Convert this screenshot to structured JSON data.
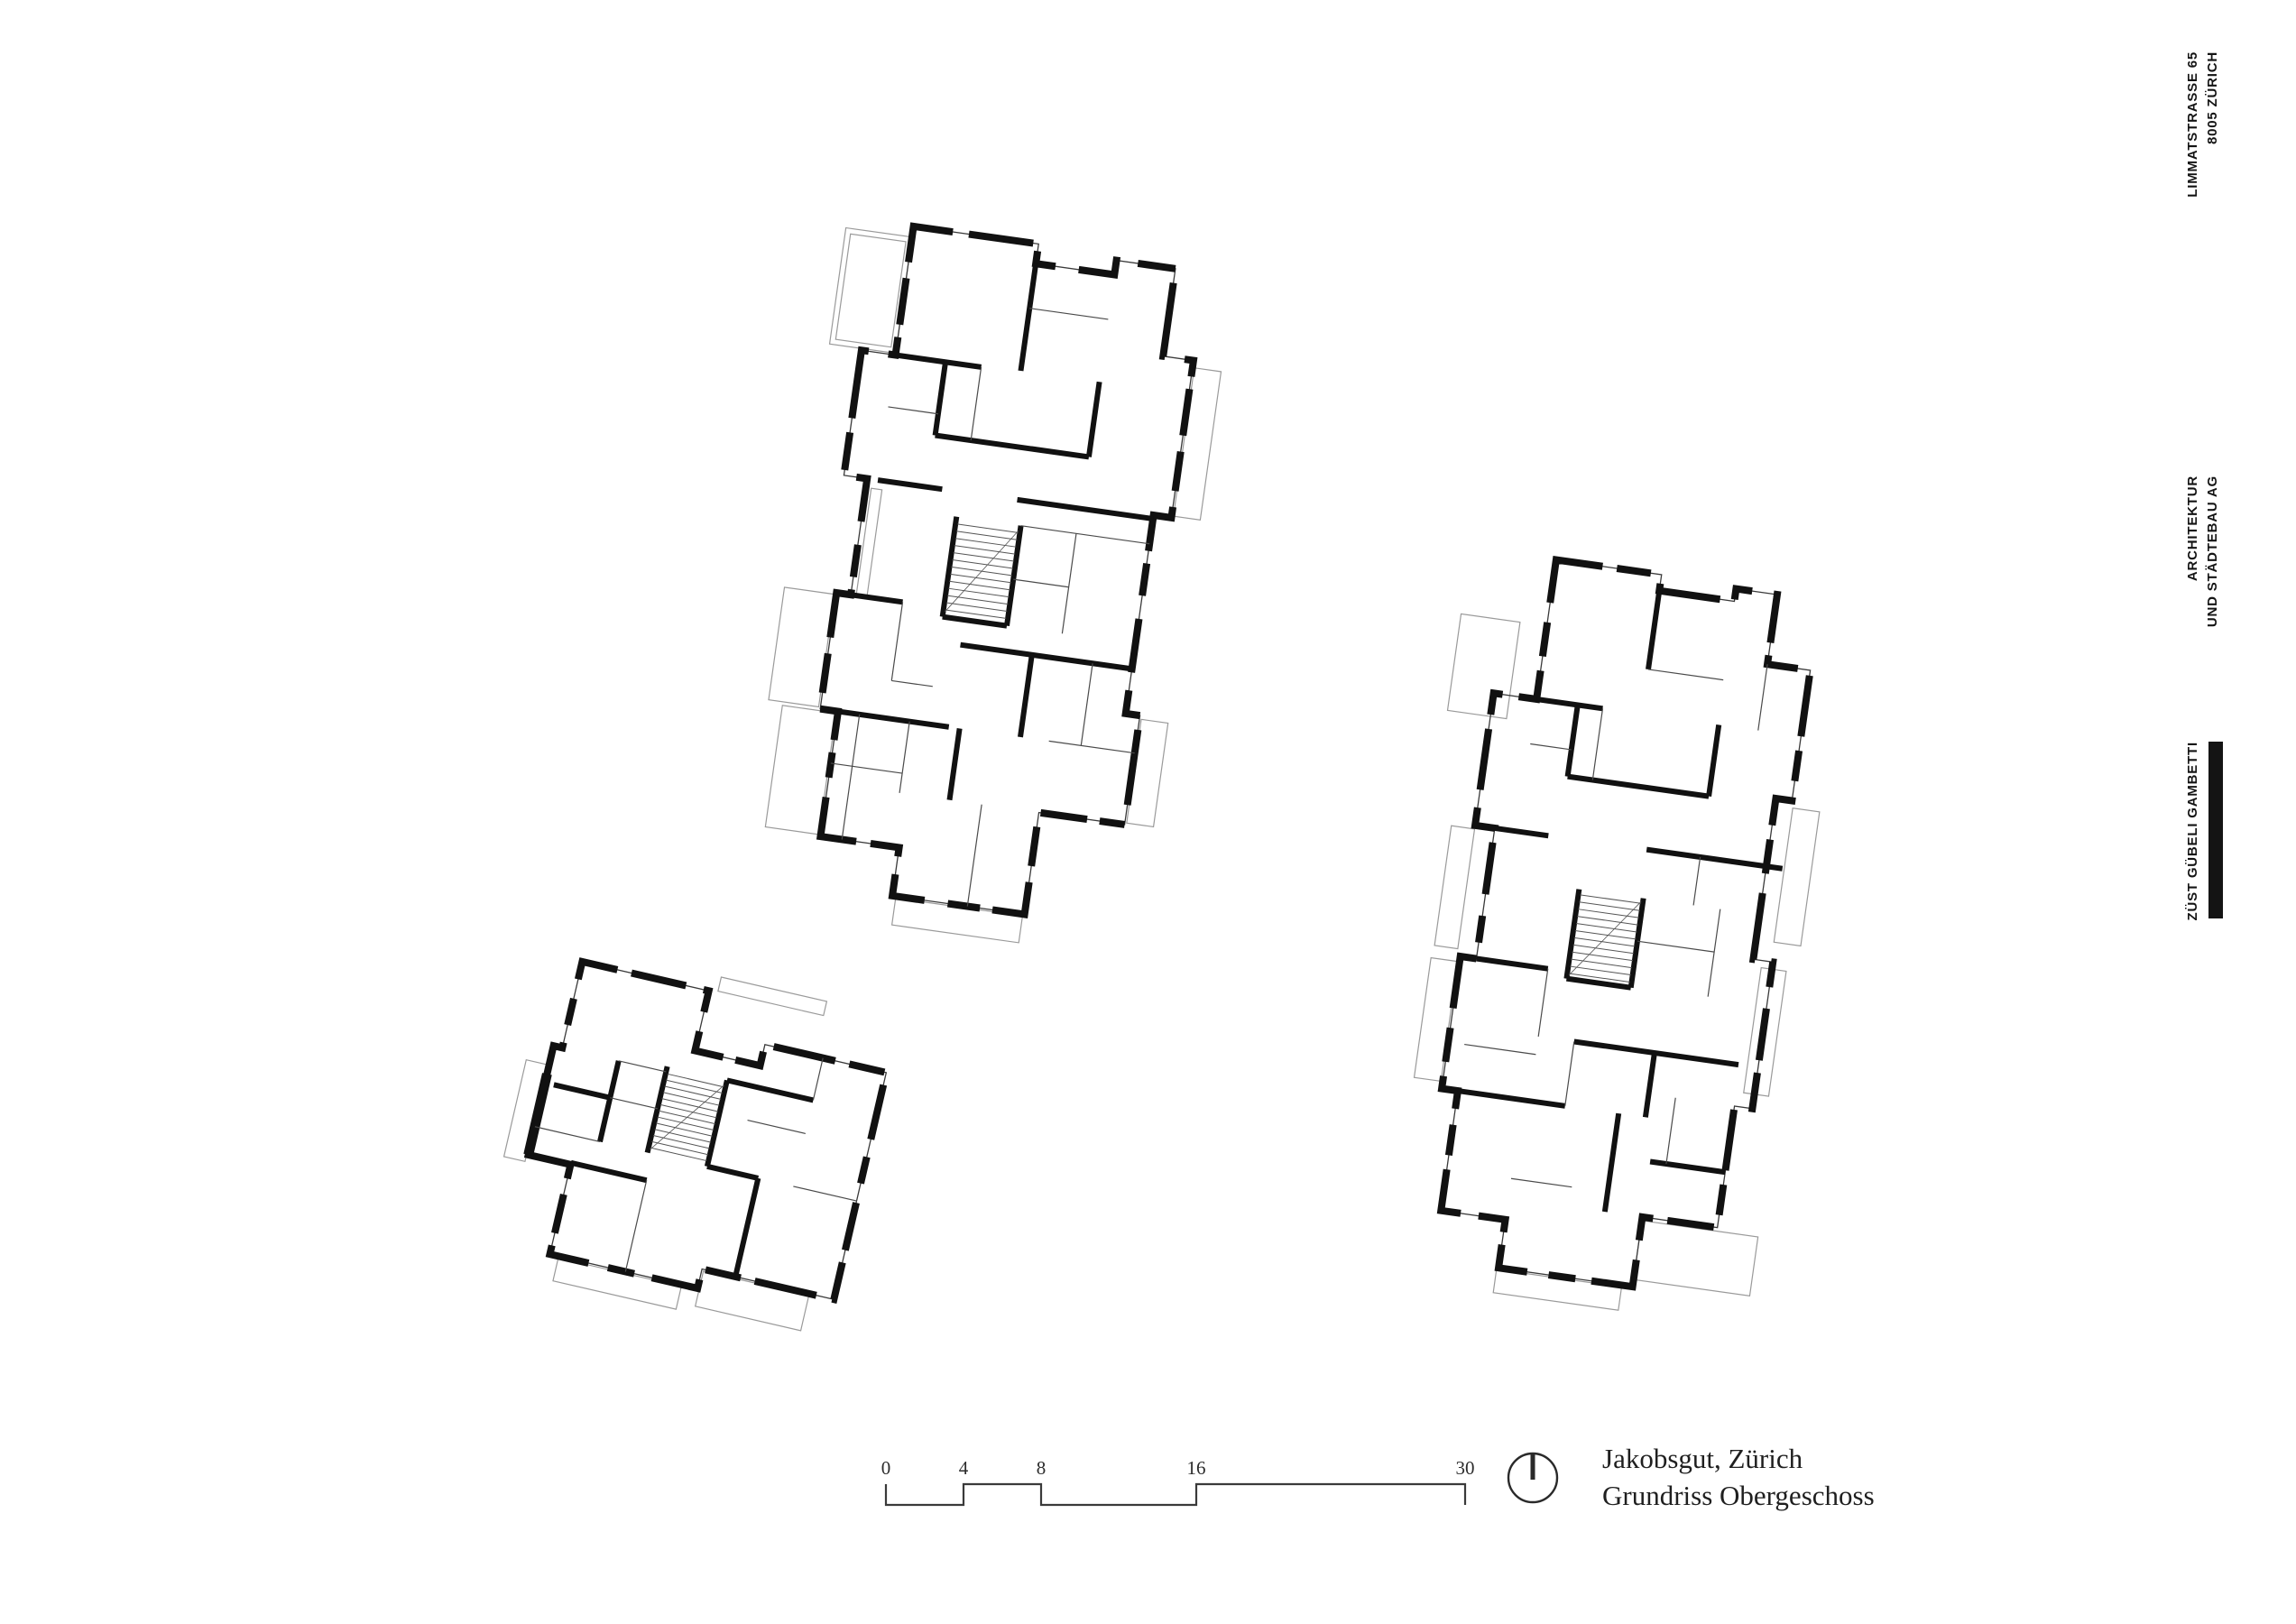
{
  "colors": {
    "ink": "#141414",
    "wall": "#111111",
    "thin_line": "#4a4a4a",
    "faint_line": "#9a9a9a",
    "text": "#1f1f1f"
  },
  "letterhead": {
    "phone": "+41 44 455 37 55",
    "website": "WWW.Z2G.CH",
    "street": "LIMMATSTRASSE 65",
    "city": "8005 ZÜRICH",
    "descriptor_line1": "ARCHITEKTUR",
    "descriptor_line2": "UND STÄDTEBAU AG",
    "firm_name": "ZÜST GÜBELI GAMBETTI"
  },
  "title_block": {
    "project": "Jakobsgut, Zürich",
    "drawing": "Grundriss Obergeschoss"
  },
  "scale_bar": {
    "labels": [
      "0",
      "4",
      "8",
      "16",
      "30"
    ]
  }
}
